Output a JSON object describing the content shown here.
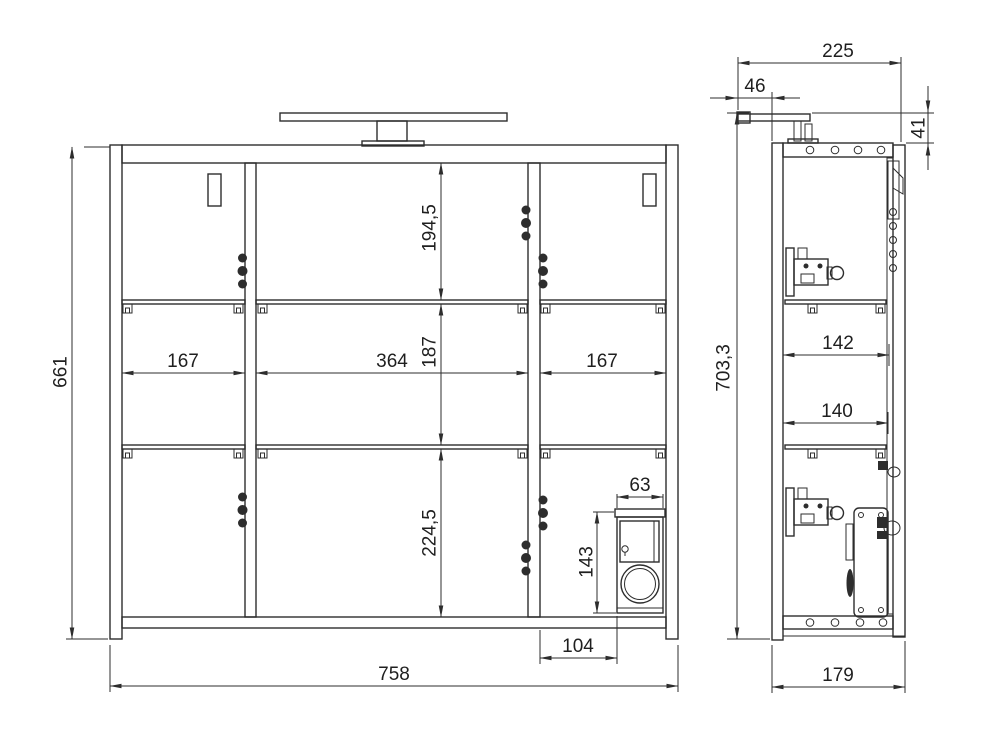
{
  "document": {
    "type": "technical-drawing",
    "subject": "mirror cabinet with lamp, front and side views",
    "background_color": "#ffffff",
    "line_color": "#2d2d2d",
    "text_color": "#1f1f1f"
  },
  "front_view": {
    "dimensions": {
      "overall_height": "661",
      "overall_width": "758",
      "left_compartment_width": "167",
      "middle_compartment_width": "364",
      "right_compartment_width": "167",
      "top_section_height": "194,5",
      "middle_section_height": "187",
      "bottom_section_height": "224,5",
      "socket_box_width": "63",
      "socket_box_height": "143",
      "socket_box_offset": "104"
    }
  },
  "side_view": {
    "dimensions": {
      "total_depth_with_lamp": "225",
      "lamp_overhang": "46",
      "lamp_height": "41",
      "total_height_with_lamp": "703,3",
      "inner_depth_upper": "142",
      "inner_depth_lower": "140",
      "body_depth": "179"
    }
  }
}
